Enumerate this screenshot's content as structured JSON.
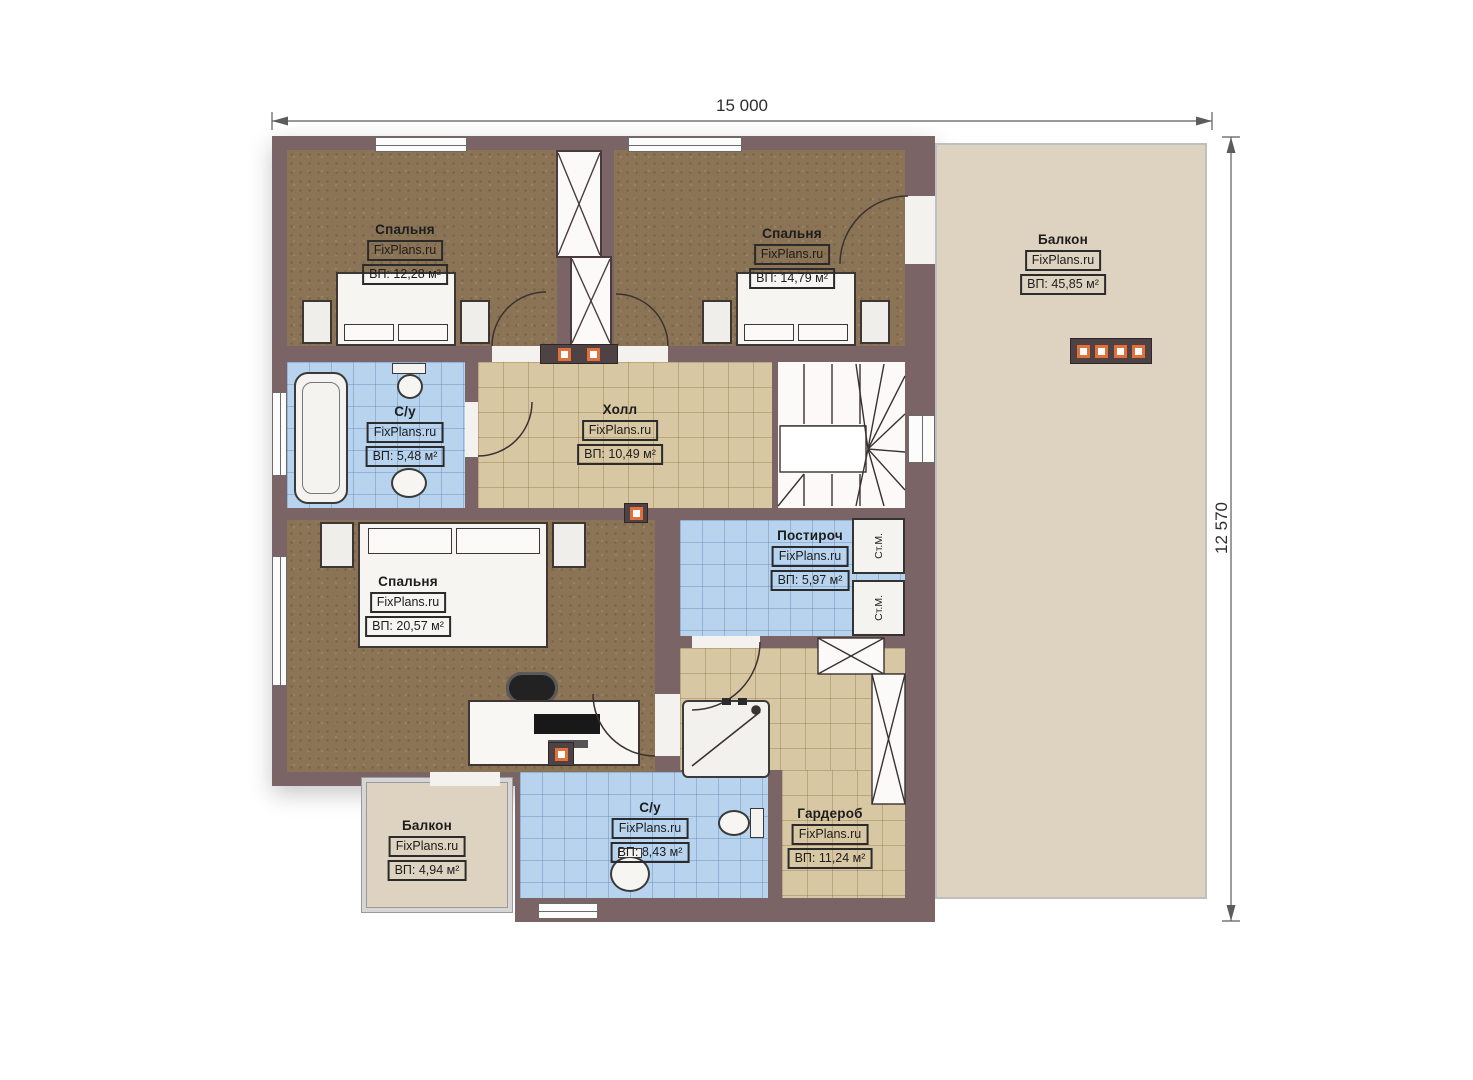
{
  "watermark": "FixPlans.ru",
  "dimensions": {
    "width": "15 000",
    "height": "12 570"
  },
  "rooms": [
    {
      "id": "bedroom-top-left",
      "name": "Спальня",
      "area": "ВП: 12,28 м²"
    },
    {
      "id": "bedroom-top-middle",
      "name": "Спальня",
      "area": "ВП: 14,79 м²"
    },
    {
      "id": "balcony-right",
      "name": "Балкон",
      "area": "ВП: 45,85 м²"
    },
    {
      "id": "bathroom-upper",
      "name": "С/у",
      "area": "ВП: 5,48 м²"
    },
    {
      "id": "hall",
      "name": "Холл",
      "area": "ВП: 10,49 м²"
    },
    {
      "id": "bedroom-bottom",
      "name": "Спальня",
      "area": "ВП: 20,57 м²"
    },
    {
      "id": "laundry",
      "name": "Постироч",
      "area": "ВП: 5,97 м²"
    },
    {
      "id": "wardrobe",
      "name": "Гардероб",
      "area": "ВП: 11,24 м²"
    },
    {
      "id": "bathroom-lower",
      "name": "С/у",
      "area": "ВП: 8,43 м²"
    },
    {
      "id": "balcony-bottom-left",
      "name": "Балкон",
      "area": "ВП: 4,94 м²"
    }
  ],
  "appliances": {
    "washer": "Ст.М."
  },
  "colors": {
    "wall": "#7a6466",
    "bedroom_floor": "#8b7356",
    "tile_blue": "#b7d3ee",
    "tile_beige": "#d8c7a3",
    "balcony": "#ded3c0",
    "accent_orange": "#e2703a"
  }
}
